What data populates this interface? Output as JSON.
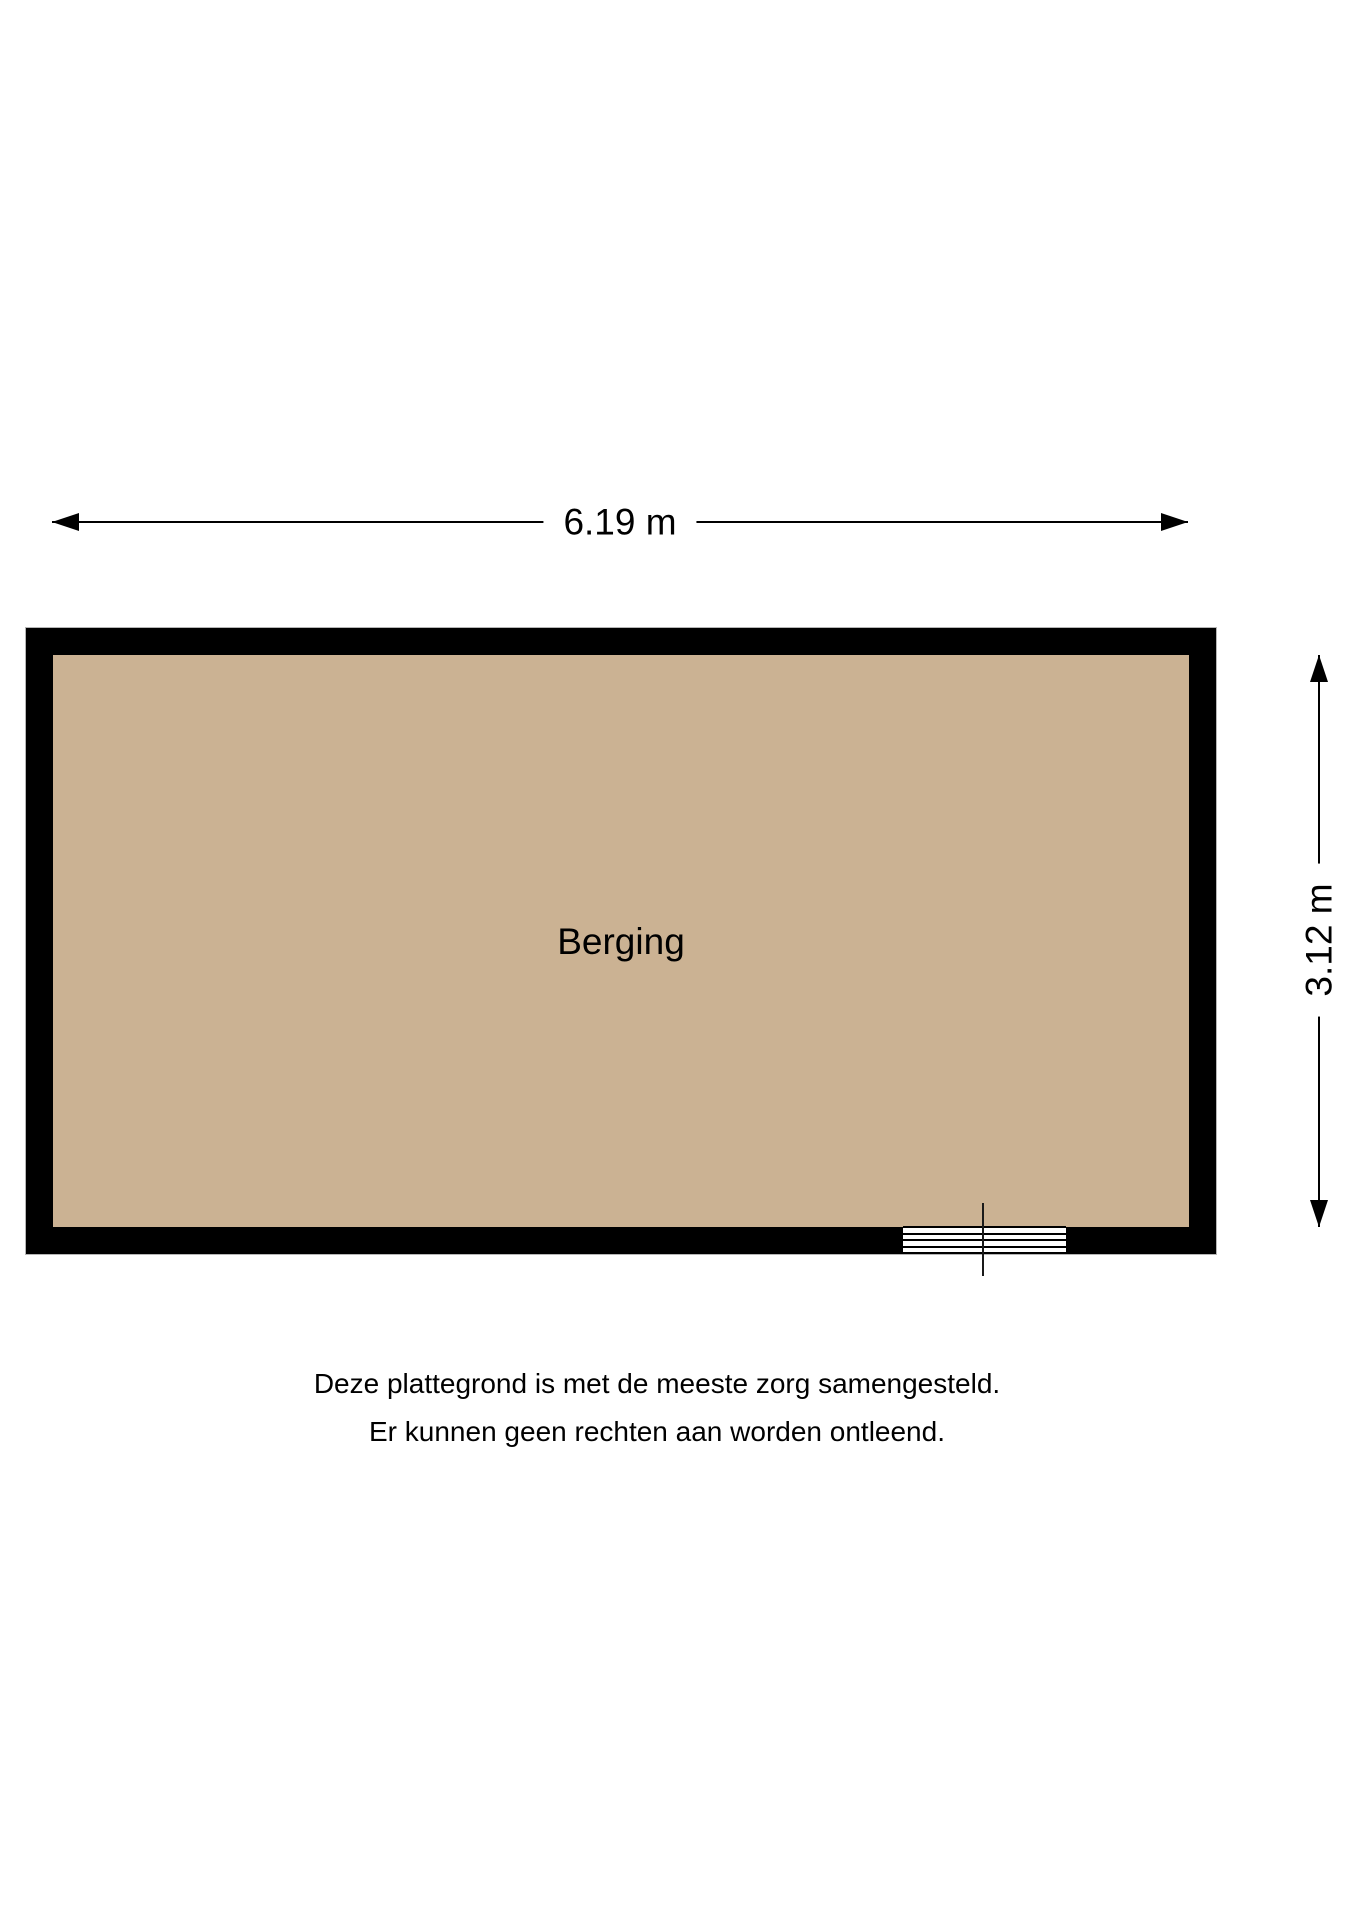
{
  "page": {
    "background_color": "#ffffff"
  },
  "floorplan": {
    "room": {
      "label": "Berging",
      "floor_color": "#cbb293",
      "wall_color": "#000000"
    },
    "dimensions": {
      "width_label": "6.19 m",
      "height_label": "3.12 m"
    },
    "disclaimer": {
      "line1": "Deze plattegrond is met de meeste zorg samengesteld.",
      "line2": "Er kunnen geen rechten aan worden ontleend."
    }
  }
}
